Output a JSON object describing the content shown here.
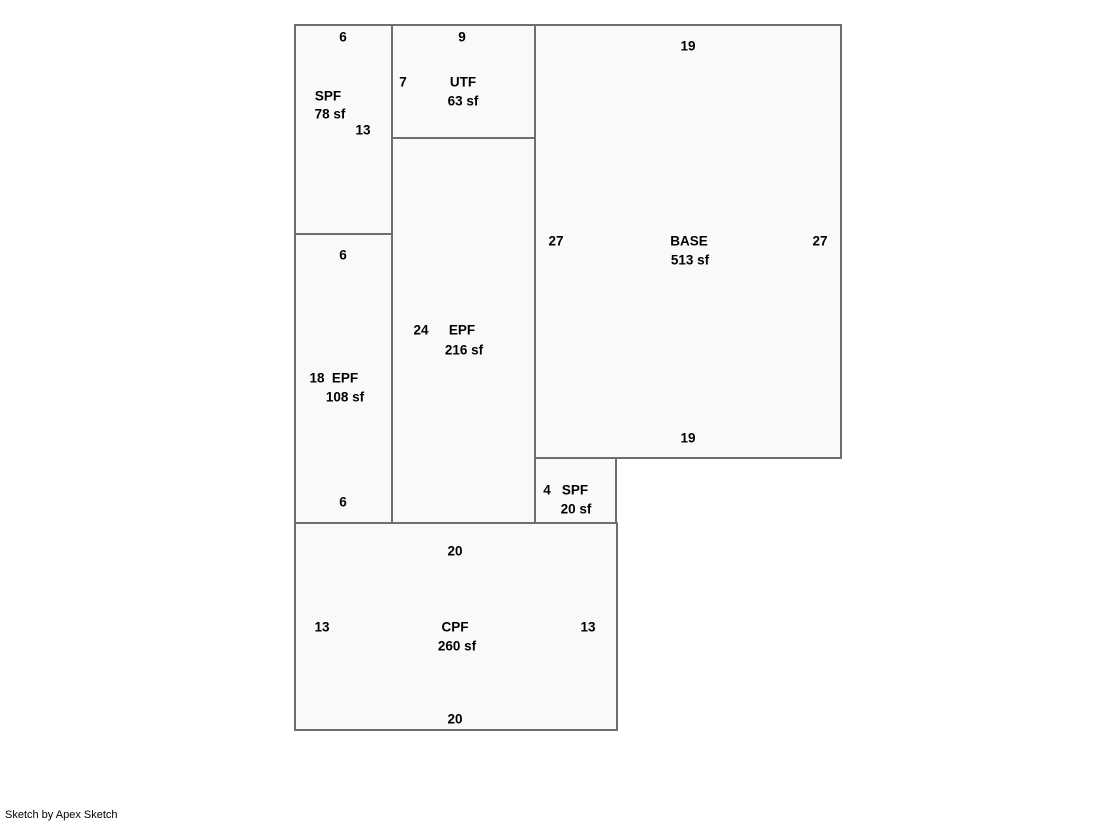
{
  "sketch": {
    "credit": "Sketch by Apex Sketch",
    "line_color": "#6e6e6e",
    "fill_color": "#f9f9f9",
    "text_color": "#000000"
  },
  "rooms": {
    "spf78": {
      "label": "SPF",
      "area": "78 sf",
      "dim_top": "6",
      "dim_right": "13"
    },
    "utf63": {
      "label": "UTF",
      "area": "63 sf",
      "dim_top": "9",
      "dim_left": "7"
    },
    "base513": {
      "label": "BASE",
      "area": "513 sf",
      "dim_top": "19",
      "dim_left": "27",
      "dim_right": "27",
      "dim_bottom": "19"
    },
    "epf216": {
      "label": "EPF",
      "area": "216 sf",
      "dim_left": "24"
    },
    "epf108": {
      "label": "EPF",
      "area": "108 sf",
      "dim_top": "6",
      "dim_left": "18",
      "dim_bottom": "6"
    },
    "spf20": {
      "label": "SPF",
      "area": "20 sf",
      "dim_left": "4"
    },
    "cpf260": {
      "label": "CPF",
      "area": "260 sf",
      "dim_top": "20",
      "dim_left": "13",
      "dim_right": "13",
      "dim_bottom": "20"
    }
  }
}
